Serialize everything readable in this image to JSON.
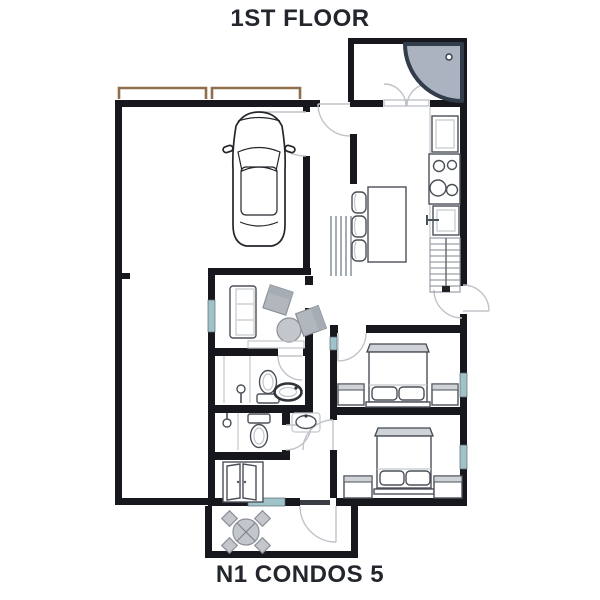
{
  "titles": {
    "top": "1ST FLOOR",
    "bottom": "N1 CONDOS 5"
  },
  "colors": {
    "wall": "#16181d",
    "text": "#23262d",
    "window": "#9fc3c9",
    "garage_door": "#8f6e4b",
    "furniture_fill": "#c3c7cc",
    "furniture_mid": "#b2b7bd",
    "furniture_stroke": "#8b9097",
    "fixture_stroke": "#4b5058",
    "shower_fill": "#aab3bf",
    "shower_stroke": "#333c4a",
    "door_arc": "#c0c4c9",
    "stair_stroke": "#9aa0a7"
  }
}
